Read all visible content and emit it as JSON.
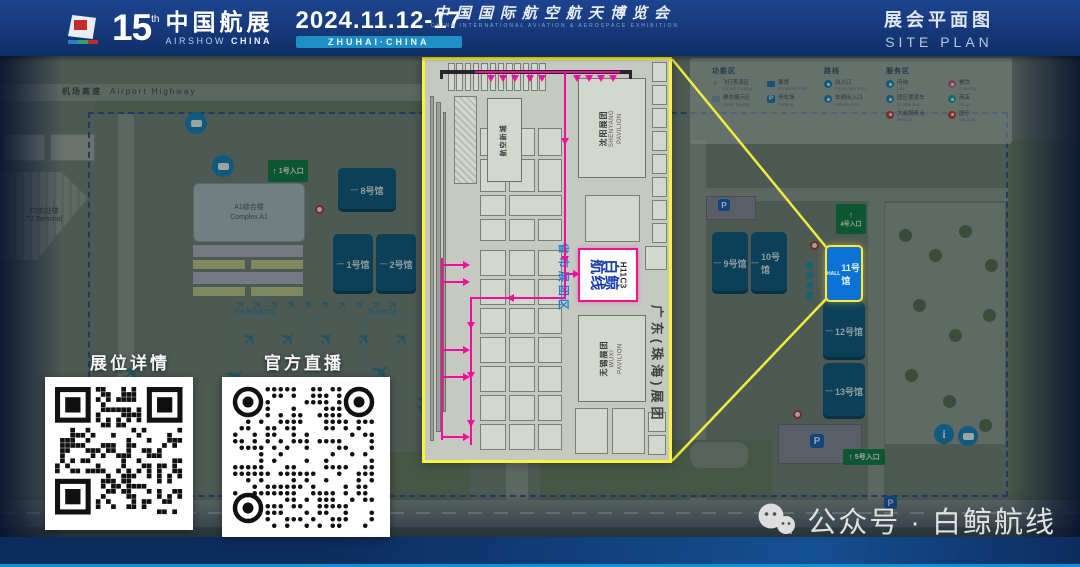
{
  "header": {
    "edition": "15",
    "edition_sup": "th",
    "title_cn": "中国航展",
    "title_en_1": "AIRSHOW",
    "title_en_2": "CHINA",
    "dates": "2024.11.12-17",
    "venue_badge": "ZHUHAI·CHINA",
    "plan_cn": "展会平面图",
    "plan_en": "SITE PLAN"
  },
  "map": {
    "highway_cn": "机场高速",
    "highway_en": "Airport Highway",
    "terminal_cn": "T2航站楼",
    "terminal_en": "T2 Terminal",
    "complex_cn": "A1综合楼",
    "complex_en": "Complex A1",
    "static_label_1": "室外静态展示区",
    "static_label_2": "静态展示区",
    "hall_dash": "一",
    "hall11_prefix": "HALL",
    "parking_label": "P",
    "info_label": "i",
    "entrance_arrow": "↑",
    "halls": [
      {
        "id": "hall-8",
        "label": "8号馆"
      },
      {
        "id": "hall-1",
        "label": "1号馆"
      },
      {
        "id": "hall-2",
        "label": "2号馆"
      },
      {
        "id": "hall-9",
        "label": "9号馆"
      },
      {
        "id": "hall-10",
        "label": "10号馆"
      },
      {
        "id": "hall-11",
        "label": "11号馆",
        "highlighted": true
      },
      {
        "id": "hall-12",
        "label": "12号馆"
      },
      {
        "id": "hall-13",
        "label": "13号馆"
      }
    ],
    "entrances": [
      {
        "label": "1号入口"
      },
      {
        "label": "4号入口"
      },
      {
        "label": "5号入口"
      }
    ],
    "legend": {
      "groups": [
        {
          "title": "功能区",
          "items": [
            {
              "cn": "飞行表演区",
              "en": "Aircraft Display",
              "icon": "plane",
              "color": "#6f8ea6"
            },
            {
              "cn": "展馆",
              "en": "Exhibition Hall",
              "icon": "square",
              "color": "#1d7dc4"
            },
            {
              "cn": "静态展示区",
              "en": "Static Display",
              "icon": "square",
              "color": "#7f9db8"
            },
            {
              "cn": "停车场",
              "en": "Parking",
              "icon": "parking",
              "color": "#1d7dc4"
            }
          ]
        },
        {
          "title": "路线",
          "items": [
            {
              "cn": "出入口",
              "en": "Passenger Entr.",
              "icon": "circle",
              "color": "#1486c8"
            },
            {
              "cn": "车辆出入口",
              "en": "Vehicle Entr.",
              "icon": "circle",
              "color": "#1486c8"
            }
          ]
        },
        {
          "title": "服务区",
          "items": [
            {
              "cn": "问询",
              "en": "Info",
              "icon": "circle",
              "color": "#1486c8"
            },
            {
              "cn": "餐饮",
              "en": "Catering",
              "icon": "circle",
              "color": "#d45a8e"
            },
            {
              "cn": "园区摆渡车",
              "en": "Shuttle Bus",
              "icon": "circle",
              "color": "#1486c8"
            },
            {
              "cn": "商店",
              "en": "Shop",
              "icon": "circle",
              "color": "#18a29a"
            },
            {
              "cn": "大会服务点",
              "en": "Service",
              "icon": "circle",
              "color": "#c43b3b"
            },
            {
              "cn": "医疗",
              "en": "Medical",
              "icon": "circle",
              "color": "#c43b3b"
            }
          ]
        }
      ]
    }
  },
  "inset": {
    "shenyang_cn": "沈阳展团",
    "shenyang_en1": "SHENYANG",
    "shenyang_en2": "PAVILION",
    "xincheng": "航空新城",
    "wuxi_cn": "无锡展团",
    "wuxi_en1": "WUXI",
    "wuxi_en2": "PAVILION",
    "zone_blue": "省市展团区",
    "zone_dark": "广东(珠海)展团",
    "highlight_no": "H11C3",
    "highlight_name_1": "白鲸",
    "highlight_name_2": "航线"
  },
  "qr": {
    "left_label": "展位详情",
    "right_label": "官方直播"
  },
  "footer": {
    "banner_cn": "中国国际航空航天博览会",
    "banner_en": "CHINA INTERNATIONAL AVIATION & AEROSPACE EXHIBITION"
  },
  "watermark": {
    "account": "公众号 · 白鲸航线"
  },
  "colors": {
    "accent_yellow": "#f8f43c",
    "route_magenta": "#ef0f9c",
    "hall_blue": "#0e5a86",
    "hall_highlight": "#0a72d4",
    "entrance_green": "#0f7f46",
    "header_navy": "#13336e",
    "badge_teal": "#1e8fc4"
  }
}
